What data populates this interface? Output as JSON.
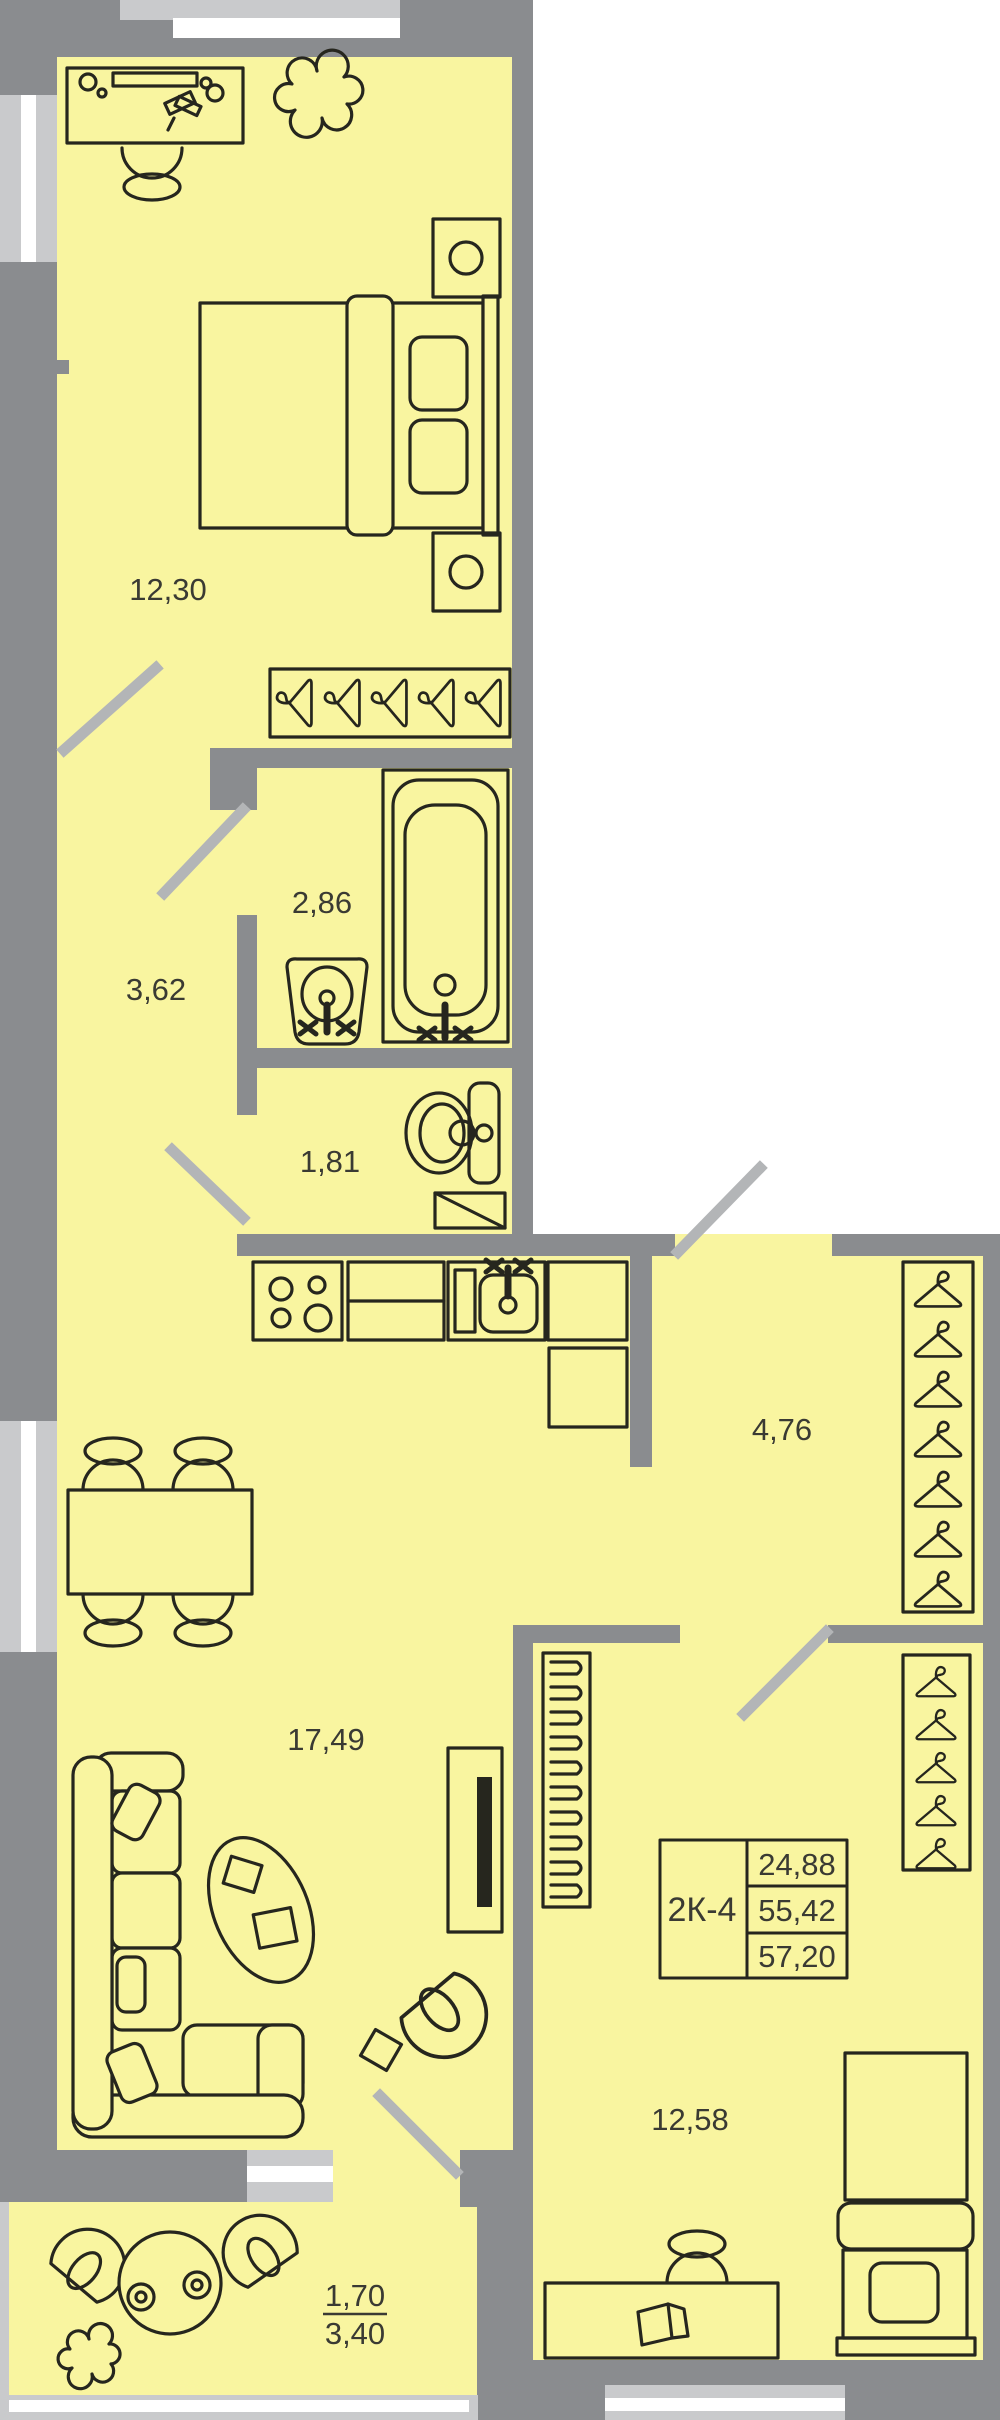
{
  "plan": {
    "unit_table": {
      "unit": "2К-4",
      "rows": [
        "24,88",
        "55,42",
        "57,20"
      ]
    },
    "rooms": {
      "bedroom1": {
        "label": "12,30"
      },
      "bathroom": {
        "label": "2,86"
      },
      "hallway": {
        "label": "3,62"
      },
      "toilet": {
        "label": "1,81"
      },
      "corridor": {
        "label": "4,76"
      },
      "living": {
        "label": "17,49"
      },
      "bedroom2": {
        "label": "12,58"
      },
      "balcony": {
        "label_top": "1,70",
        "label_bottom": "3,40"
      }
    },
    "colors": {
      "floor": "#F9F5A0",
      "wall": "#8A8C8F",
      "window_light": "#C9CACC",
      "door_leaf": "#B3B5B7",
      "furniture_line": "#26261E"
    }
  }
}
